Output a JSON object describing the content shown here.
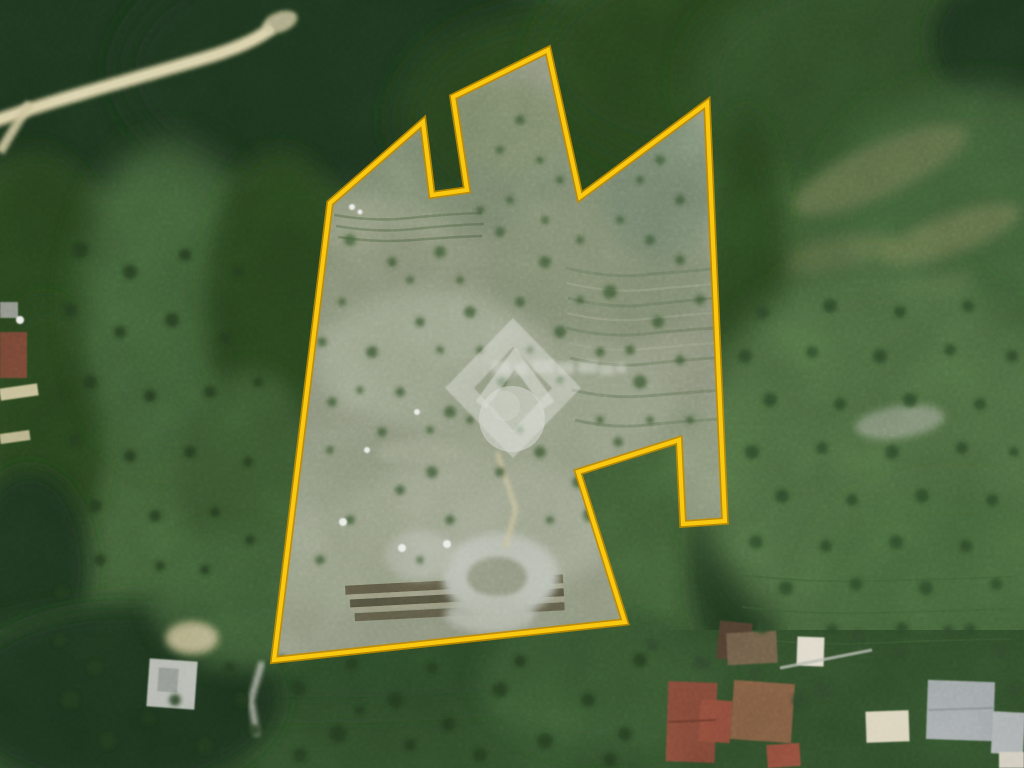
{
  "scene": {
    "type": "aerial-satellite-photograph",
    "description": "Satellite view of a rural hillside property outlined in yellow; wooded slopes above and left, orchard fields to the right, olive-grove pasture below, and a cluster of village rooftops in the bottom-right corner. A semi-transparent white house-logo watermark sits at the centre.",
    "width_px": 1024,
    "height_px": 768
  },
  "parcel": {
    "boundary_points": "330,203 423,122 432,195 467,190 453,97 548,50 580,197 707,103 725,521 683,524 679,440 578,472 625,622 274,660",
    "boundary_color": "#f9c810",
    "boundary_edge_color": "#c08a00",
    "interior_color": "#8c927c"
  },
  "watermark": {
    "color": "#ffffff",
    "opacity": 0.62,
    "logo": "diamond ring with roof chevron above a circle",
    "text": "unreadable blurred wordmark"
  },
  "palette": {
    "base_green": "#3e5a34",
    "forest_dark": "#1e331d",
    "field_green": "#4a653e",
    "pasture_green": "#2f4a29",
    "track_tan": "#cbc29a",
    "clearing_grey": "#b4b9ad",
    "roof_red": "#7c4434",
    "roof_grey": "#9ba1a3",
    "roof_cream": "#d9d2ba",
    "vehicle_white": "#e9ebe5"
  },
  "scatter": {
    "trees_bottom": [
      [
        70,
        700,
        9
      ],
      [
        108,
        741,
        8
      ],
      [
        148,
        718,
        7
      ],
      [
        205,
        746,
        8
      ],
      [
        242,
        700,
        7
      ],
      [
        298,
        688,
        8
      ],
      [
        338,
        734,
        9
      ],
      [
        395,
        700,
        8
      ],
      [
        448,
        724,
        7
      ],
      [
        500,
        690,
        8
      ],
      [
        545,
        741,
        8
      ],
      [
        588,
        700,
        7
      ],
      [
        625,
        734,
        7
      ],
      [
        520,
        661,
        6
      ],
      [
        432,
        668,
        6
      ],
      [
        352,
        664,
        6
      ],
      [
        282,
        660,
        5
      ],
      [
        230,
        668,
        6
      ],
      [
        175,
        700,
        6
      ],
      [
        95,
        668,
        7
      ],
      [
        60,
        640,
        6
      ],
      [
        640,
        660,
        7
      ],
      [
        610,
        760,
        7
      ],
      [
        300,
        755,
        7
      ],
      [
        360,
        710,
        5
      ],
      [
        480,
        755,
        7
      ],
      [
        410,
        745,
        6
      ],
      [
        255,
        730,
        6
      ]
    ],
    "trees_left": [
      [
        80,
        250,
        8
      ],
      [
        130,
        272,
        7
      ],
      [
        185,
        255,
        6
      ],
      [
        238,
        272,
        6
      ],
      [
        70,
        310,
        7
      ],
      [
        120,
        332,
        6
      ],
      [
        172,
        320,
        7
      ],
      [
        225,
        338,
        6
      ],
      [
        90,
        382,
        7
      ],
      [
        150,
        396,
        6
      ],
      [
        210,
        392,
        6
      ],
      [
        258,
        382,
        5
      ],
      [
        75,
        440,
        7
      ],
      [
        130,
        456,
        6
      ],
      [
        190,
        452,
        6
      ],
      [
        248,
        462,
        5
      ],
      [
        95,
        506,
        7
      ],
      [
        155,
        516,
        6
      ],
      [
        215,
        512,
        5
      ],
      [
        100,
        560,
        6
      ],
      [
        160,
        566,
        5
      ],
      [
        62,
        592,
        6
      ],
      [
        205,
        570,
        5
      ],
      [
        250,
        540,
        5
      ]
    ],
    "trees_right_field": [
      [
        762,
        312,
        7
      ],
      [
        830,
        306,
        7
      ],
      [
        900,
        312,
        6
      ],
      [
        968,
        306,
        6
      ],
      [
        745,
        356,
        7
      ],
      [
        812,
        352,
        6
      ],
      [
        880,
        356,
        7
      ],
      [
        950,
        350,
        6
      ],
      [
        1012,
        356,
        6
      ],
      [
        770,
        400,
        7
      ],
      [
        840,
        404,
        6
      ],
      [
        910,
        400,
        7
      ],
      [
        980,
        404,
        6
      ],
      [
        752,
        452,
        7
      ],
      [
        822,
        448,
        6
      ],
      [
        892,
        452,
        7
      ],
      [
        962,
        448,
        6
      ],
      [
        1014,
        452,
        5
      ],
      [
        782,
        496,
        7
      ],
      [
        852,
        500,
        6
      ],
      [
        922,
        496,
        7
      ],
      [
        992,
        500,
        6
      ],
      [
        756,
        542,
        7
      ],
      [
        826,
        546,
        6
      ],
      [
        896,
        542,
        7
      ],
      [
        966,
        546,
        6
      ],
      [
        786,
        588,
        7
      ],
      [
        856,
        584,
        6
      ],
      [
        926,
        588,
        7
      ],
      [
        996,
        584,
        6
      ],
      [
        762,
        628,
        6
      ],
      [
        832,
        630,
        6
      ],
      [
        902,
        628,
        6
      ],
      [
        970,
        630,
        6
      ]
    ],
    "trees_near_buildings": [
      [
        858,
        636,
        6
      ],
      [
        900,
        652,
        6
      ],
      [
        948,
        630,
        5
      ],
      [
        1000,
        652,
        6
      ],
      [
        822,
        690,
        9
      ],
      [
        700,
        662,
        7
      ],
      [
        652,
        645,
        6
      ],
      [
        1014,
        690,
        6
      ],
      [
        705,
        664,
        6
      ],
      [
        755,
        672,
        6
      ],
      [
        800,
        700,
        8
      ]
    ],
    "shrubs_in_parcel": [
      [
        350,
        240,
        6
      ],
      [
        392,
        262,
        5
      ],
      [
        440,
        252,
        6
      ],
      [
        500,
        232,
        5
      ],
      [
        545,
        262,
        6
      ],
      [
        610,
        292,
        7
      ],
      [
        658,
        322,
        6
      ],
      [
        640,
        382,
        7
      ],
      [
        600,
        352,
        5
      ],
      [
        560,
        332,
        6
      ],
      [
        520,
        302,
        5
      ],
      [
        470,
        312,
        6
      ],
      [
        420,
        322,
        5
      ],
      [
        372,
        352,
        6
      ],
      [
        400,
        392,
        5
      ],
      [
        450,
        412,
        6
      ],
      [
        502,
        382,
        5
      ],
      [
        540,
        452,
        6
      ],
      [
        578,
        482,
        6
      ],
      [
        618,
        442,
        5
      ],
      [
        500,
        472,
        5
      ],
      [
        432,
        472,
        6
      ],
      [
        382,
        432,
        5
      ],
      [
        332,
        402,
        5
      ],
      [
        322,
        342,
        5
      ],
      [
        342,
        302,
        4
      ],
      [
        658,
        472,
        6
      ],
      [
        640,
        522,
        5
      ],
      [
        608,
        490,
        12
      ],
      [
        590,
        515,
        7
      ],
      [
        450,
        520,
        5
      ],
      [
        400,
        490,
        5
      ],
      [
        350,
        520,
        5
      ],
      [
        320,
        560,
        5
      ],
      [
        420,
        560,
        4
      ],
      [
        550,
        520,
        4
      ],
      [
        470,
        420,
        4
      ],
      [
        430,
        430,
        4
      ],
      [
        360,
        390,
        4
      ],
      [
        330,
        450,
        4
      ],
      [
        560,
        380,
        4
      ],
      [
        600,
        420,
        4
      ],
      [
        650,
        420,
        4
      ],
      [
        520,
        430,
        4
      ],
      [
        480,
        350,
        4
      ],
      [
        440,
        350,
        4
      ],
      [
        410,
        280,
        4
      ],
      [
        460,
        280,
        4
      ],
      [
        530,
        350,
        4
      ],
      [
        580,
        300,
        4
      ],
      [
        630,
        350,
        5
      ],
      [
        680,
        360,
        5
      ],
      [
        690,
        420,
        4
      ],
      [
        700,
        300,
        5
      ],
      [
        680,
        260,
        5
      ],
      [
        650,
        240,
        5
      ],
      [
        620,
        220,
        4
      ],
      [
        580,
        240,
        4
      ],
      [
        545,
        220,
        4
      ],
      [
        510,
        200,
        4
      ],
      [
        480,
        210,
        4
      ],
      [
        520,
        120,
        5
      ],
      [
        540,
        160,
        4
      ],
      [
        560,
        180,
        4
      ],
      [
        500,
        150,
        4
      ],
      [
        660,
        160,
        5
      ],
      [
        680,
        200,
        5
      ],
      [
        640,
        180,
        4
      ]
    ],
    "white_dots": [
      [
        343,
        522,
        4
      ],
      [
        402,
        548,
        4
      ],
      [
        447,
        544,
        4
      ],
      [
        367,
        450,
        3
      ],
      [
        417,
        412,
        3
      ],
      [
        352,
        207,
        3
      ],
      [
        360,
        212,
        2.5
      ]
    ]
  }
}
